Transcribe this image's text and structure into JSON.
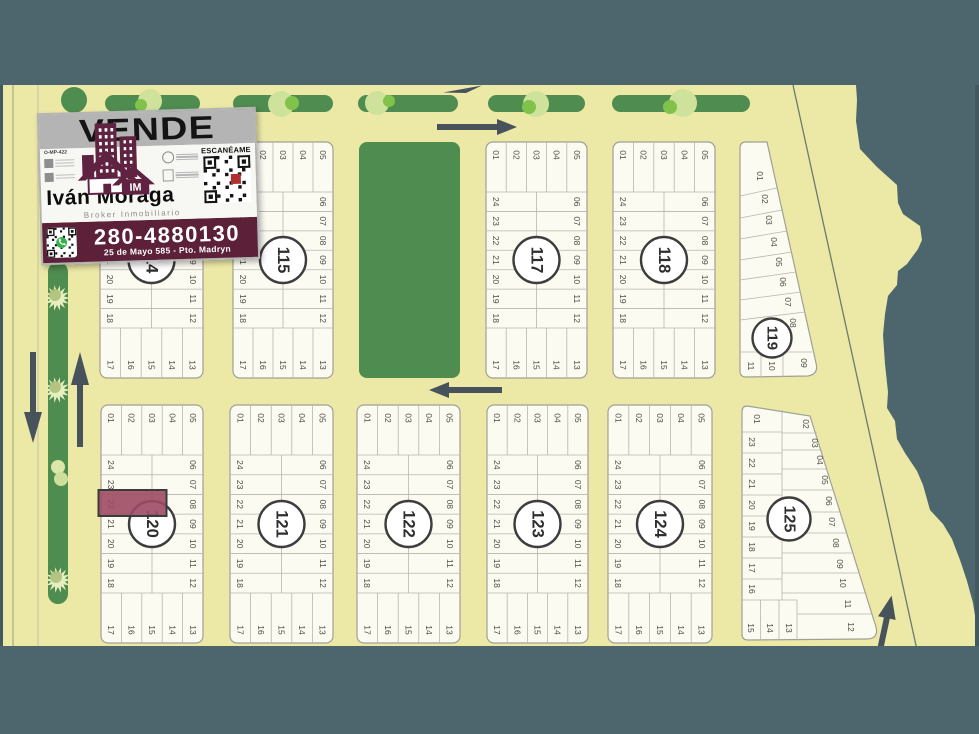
{
  "ad": {
    "headline": "VENDE",
    "ref_code": "O-MP-422",
    "agent_name": "Iván Moraga",
    "agent_role": "Broker Inmobiliario",
    "logo_initials": "IM",
    "scan_label": "ESCANÉAME",
    "phone": "280-4880130",
    "address": "25 de Mayo 585 - Pto. Madryn"
  },
  "colors": {
    "brand_maroon": "#5c2038",
    "highlight_lot": "#9d4a64",
    "map_green": "#4f8c4f",
    "sea_teal": "#4d666e",
    "land_cream": "#ece9a7"
  },
  "map": {
    "highlight": {
      "block": "120",
      "lot": "22"
    },
    "blocks": [
      {
        "number": "114",
        "type": "standard",
        "top": [
          "01",
          "02",
          "03",
          "04",
          "05"
        ],
        "right": [
          "06",
          "07",
          "08",
          "09",
          "10",
          "11",
          "12"
        ],
        "left": [
          "24",
          "23",
          "22",
          "21",
          "20",
          "19",
          "18"
        ],
        "bottom": [
          "17",
          "16",
          "15",
          "14",
          "13"
        ]
      },
      {
        "number": "115",
        "type": "standard",
        "top": [
          "01",
          "02",
          "03",
          "04",
          "05"
        ],
        "right": [
          "06",
          "07",
          "08",
          "09",
          "10",
          "11",
          "12"
        ],
        "left": [
          "24",
          "23",
          "22",
          "21",
          "20",
          "19",
          "18"
        ],
        "bottom": [
          "17",
          "16",
          "15",
          "14",
          "13"
        ]
      },
      {
        "number": "117",
        "type": "standard",
        "top": [
          "01",
          "02",
          "03",
          "04",
          "05"
        ],
        "right": [
          "06",
          "07",
          "08",
          "09",
          "10",
          "11",
          "12"
        ],
        "left": [
          "24",
          "23",
          "22",
          "21",
          "20",
          "19",
          "18"
        ],
        "bottom": [
          "17",
          "16",
          "15",
          "14",
          "13"
        ]
      },
      {
        "number": "118",
        "type": "standard",
        "top": [
          "01",
          "02",
          "03",
          "04",
          "05"
        ],
        "right": [
          "06",
          "07",
          "08",
          "09",
          "10",
          "11",
          "12"
        ],
        "left": [
          "24",
          "23",
          "22",
          "21",
          "20",
          "19",
          "18"
        ],
        "bottom": [
          "17",
          "16",
          "15",
          "14",
          "13"
        ]
      },
      {
        "number": "119",
        "type": "coastal-triangle",
        "slant": [
          "01",
          "02",
          "03",
          "04",
          "05",
          "06",
          "07",
          "08"
        ],
        "bottom": [
          "11",
          "10",
          "09"
        ]
      },
      {
        "number": "120",
        "type": "standard",
        "top": [
          "01",
          "02",
          "03",
          "04",
          "05"
        ],
        "right": [
          "06",
          "07",
          "08",
          "09",
          "10",
          "11",
          "12"
        ],
        "left": [
          "24",
          "23",
          "22",
          "21",
          "20",
          "19",
          "18"
        ],
        "bottom": [
          "17",
          "16",
          "15",
          "14",
          "13"
        ]
      },
      {
        "number": "121",
        "type": "standard",
        "top": [
          "01",
          "02",
          "03",
          "04",
          "05"
        ],
        "right": [
          "06",
          "07",
          "08",
          "09",
          "10",
          "11",
          "12"
        ],
        "left": [
          "24",
          "23",
          "22",
          "21",
          "20",
          "19",
          "18"
        ],
        "bottom": [
          "17",
          "16",
          "15",
          "14",
          "13"
        ]
      },
      {
        "number": "122",
        "type": "standard",
        "top": [
          "01",
          "02",
          "03",
          "04",
          "05"
        ],
        "right": [
          "06",
          "07",
          "08",
          "09",
          "10",
          "11",
          "12"
        ],
        "left": [
          "24",
          "23",
          "22",
          "21",
          "20",
          "19",
          "18"
        ],
        "bottom": [
          "17",
          "16",
          "15",
          "14",
          "13"
        ]
      },
      {
        "number": "123",
        "type": "standard",
        "top": [
          "01",
          "02",
          "03",
          "04",
          "05"
        ],
        "right": [
          "06",
          "07",
          "08",
          "09",
          "10",
          "11",
          "12"
        ],
        "left": [
          "24",
          "23",
          "22",
          "21",
          "20",
          "19",
          "18"
        ],
        "bottom": [
          "17",
          "16",
          "15",
          "14",
          "13"
        ]
      },
      {
        "number": "124",
        "type": "standard",
        "top": [
          "01",
          "02",
          "03",
          "04",
          "05"
        ],
        "right": [
          "06",
          "07",
          "08",
          "09",
          "10",
          "11",
          "12"
        ],
        "left": [
          "24",
          "23",
          "22",
          "21",
          "20",
          "19",
          "18"
        ],
        "bottom": [
          "17",
          "16",
          "15",
          "14",
          "13"
        ]
      },
      {
        "number": "125",
        "type": "coastal-trapezoid",
        "top": [
          "01",
          "02"
        ],
        "left": [
          "23",
          "22",
          "21",
          "20",
          "19",
          "18",
          "17",
          "16"
        ],
        "slant": [
          "03",
          "04",
          "05",
          "06",
          "07",
          "08",
          "09",
          "10",
          "11",
          "12"
        ],
        "bottom": [
          "15",
          "14",
          "13"
        ]
      }
    ]
  }
}
